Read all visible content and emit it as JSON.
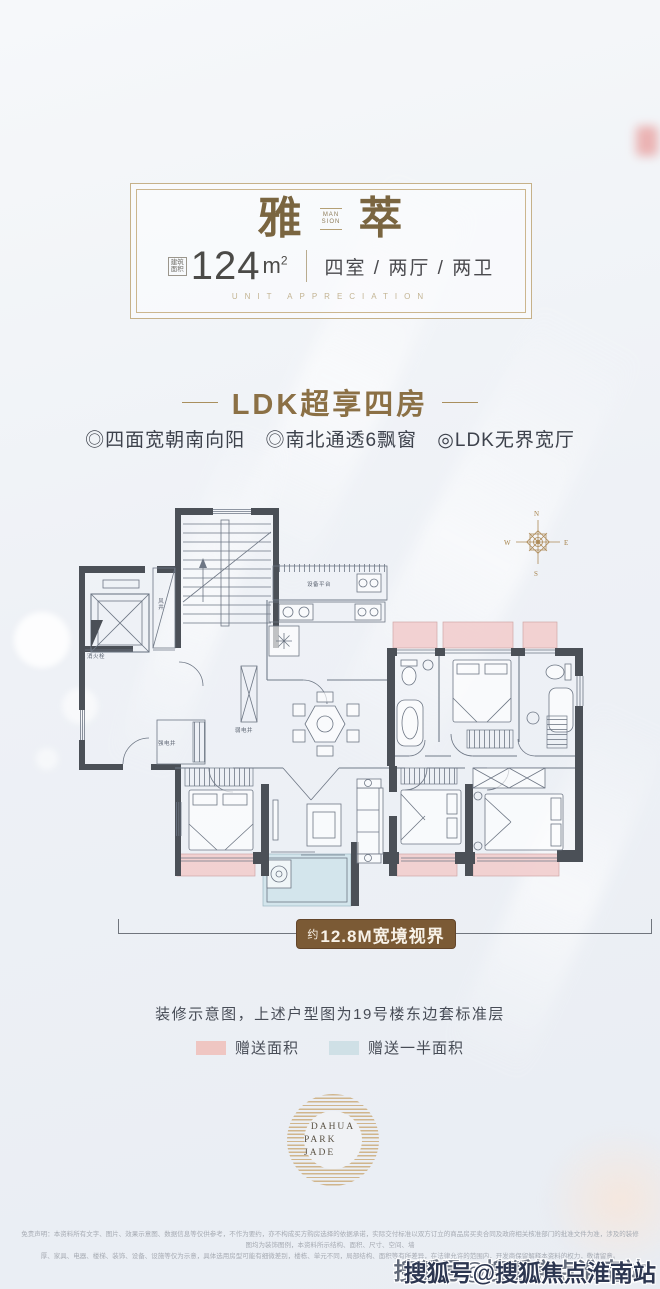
{
  "card": {
    "title_left": "雅",
    "title_right": "萃",
    "seal_top": "MAN",
    "seal_bottom": "SION",
    "area_label_top": "建筑",
    "area_label_bottom": "面积",
    "area_value": "124",
    "area_unit": "m",
    "area_unit_sup": "2",
    "rooms": "四室 / 两厅 / 两卫",
    "subtitle": "UNIT APPRECIATION"
  },
  "headline": {
    "text": "LDK超享四房"
  },
  "bullets": [
    "◎四面宽朝南向阳",
    "◎南北通透6飘窗",
    "◎LDK无界宽厅"
  ],
  "plan": {
    "compass": {
      "n": "N",
      "e": "E",
      "s": "S",
      "w": "W"
    },
    "labels": {
      "wind_shaft": "风井",
      "fire_hydrant": "消火栓",
      "equip_platform": "设备平台",
      "weak_shaft": "弱电井",
      "strong_shaft": "强电井"
    },
    "banner": {
      "prefix": "约",
      "text": "12.8M宽境视界"
    }
  },
  "caption": "装修示意图，上述户型图为19号楼东边套标准层",
  "legend": [
    {
      "label": "赠送面积",
      "color": "#efc6c2"
    },
    {
      "label": "赠送一半面积",
      "color": "#cfe0e6"
    }
  ],
  "logo": {
    "line1": "DAHUA",
    "line2": "PARK JADE"
  },
  "disclaimer": [
    "免责声明：本资料所有文字、图片、效果示意图、数据信息等仅供参考，不作为要约，亦不构成买方购房选择的依据承诺，实际交付标准以双方订立的商品房买卖合同及政府相关核准部门的批准文件为准，涉及的装修图均为装饰图例，本资料所示结构、面积、尺寸、空间、墙",
    "厚、家具、电器、楼梯、装饰、设备、设施等仅为示意，具体选用房型可能有细微差别，楼栋、单元不同，局部结构、面积等有所差异，在法律允许的范围内，开发商保留解释本资料的权力，敬请留意。"
  ],
  "watermark": "搜狐号@搜狐焦点淮南站",
  "colors": {
    "accent_bronze": "#8b7045",
    "banner_bg": "#7b5a35",
    "wall": "#4b5057",
    "gift_area_pink": "#f2cdcd",
    "half_gift_blue": "#d2e4eb",
    "logo_gold": "#d0b58c"
  }
}
